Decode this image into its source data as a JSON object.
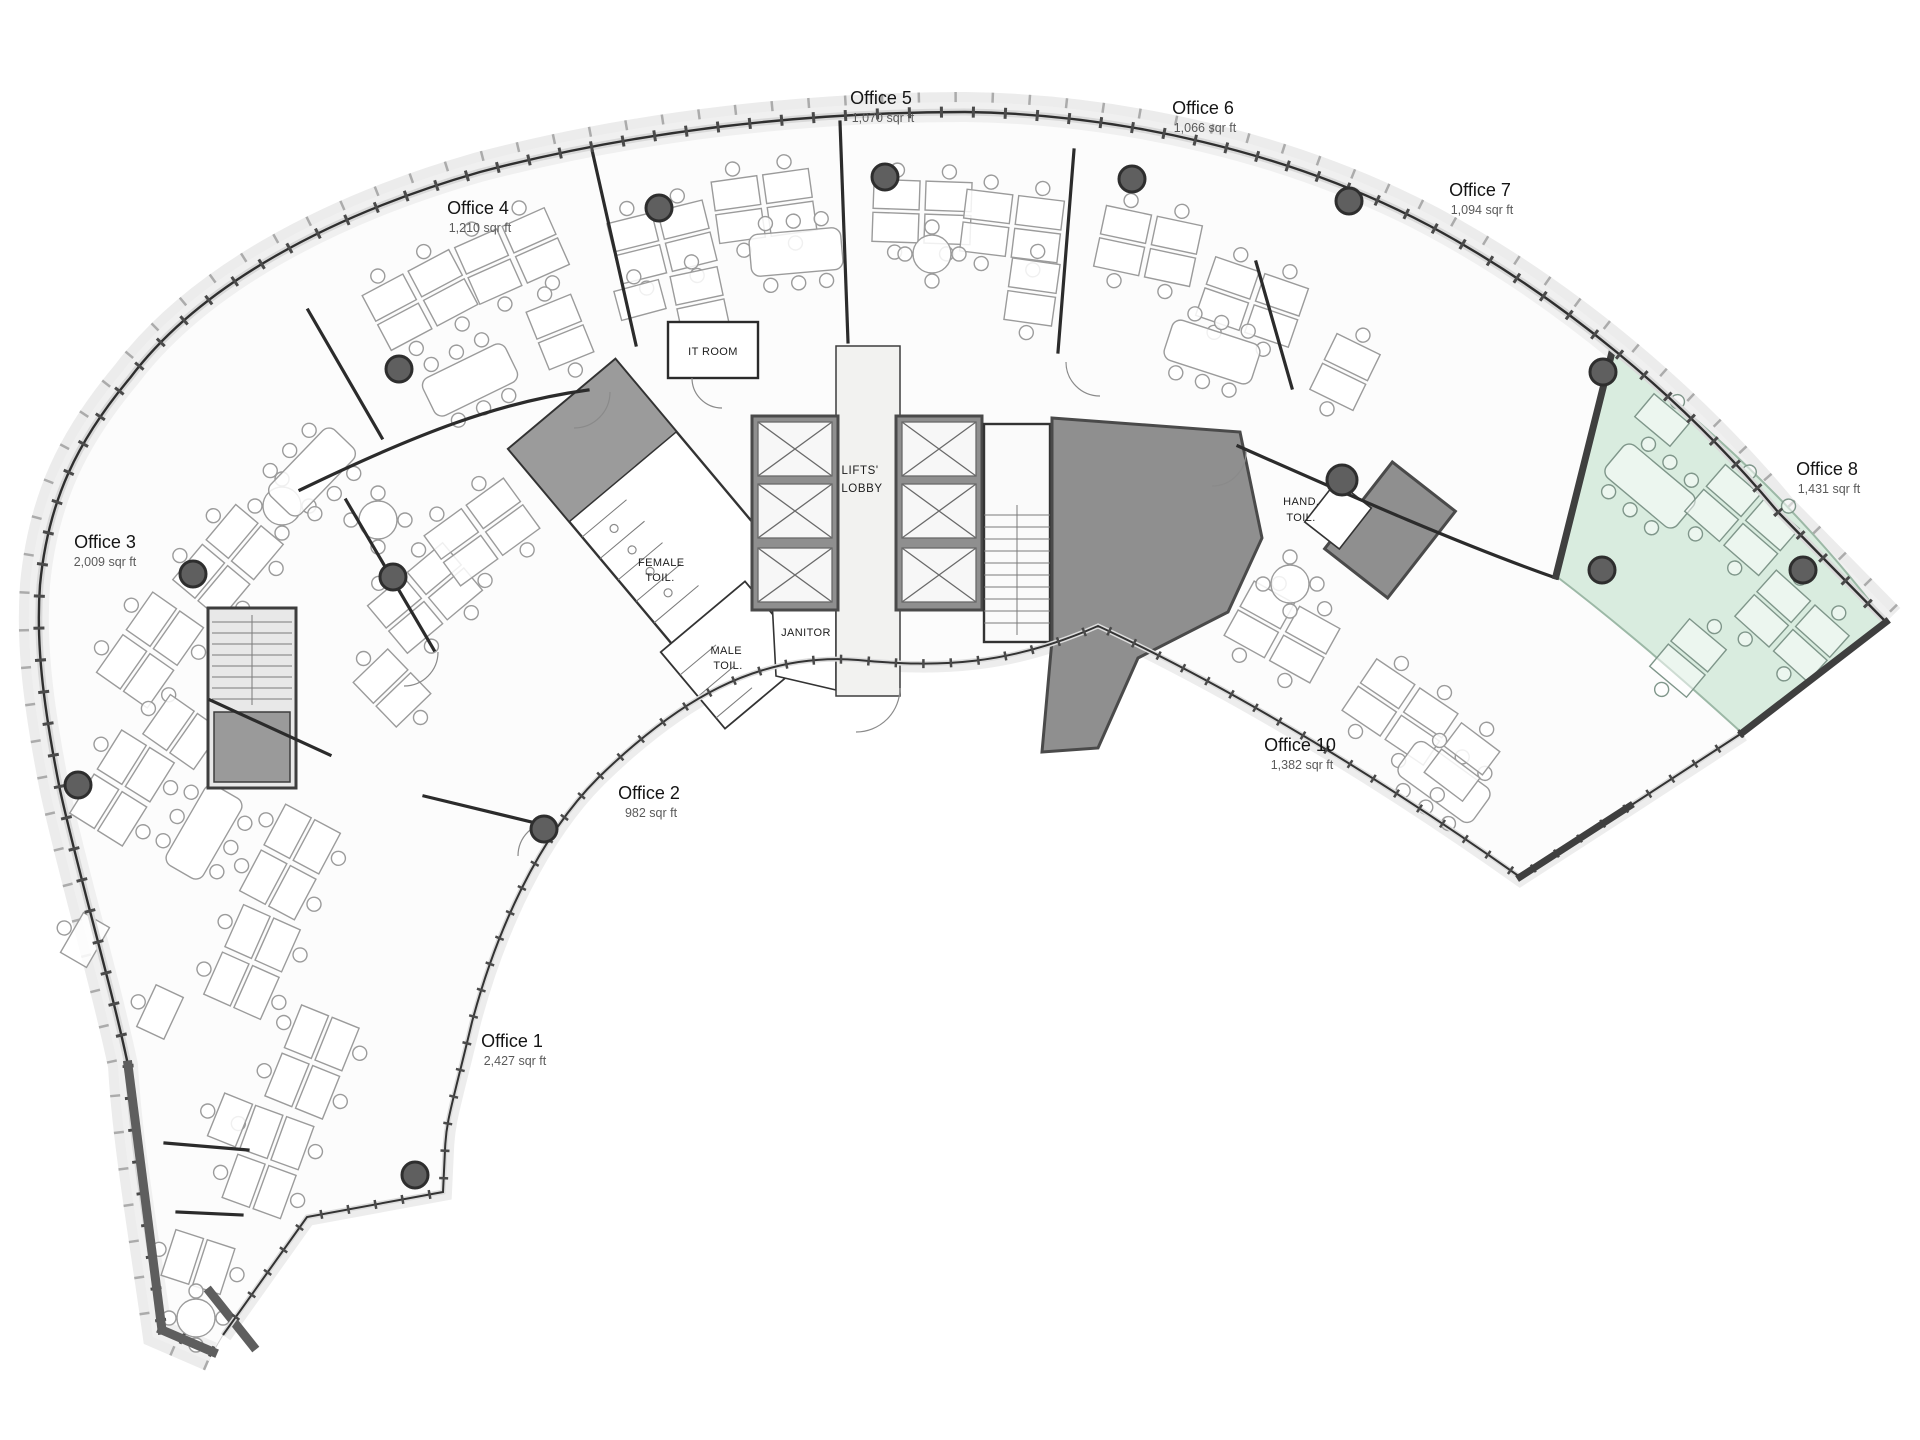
{
  "plan": {
    "kind": "office-floor-plan",
    "highlighted_office": "Office 8"
  },
  "colors": {
    "highlight": "#d9ecdf",
    "highlight_edge": "#9cb8a6",
    "column": "#5f5f5f",
    "core": "#8f8f8f"
  },
  "offices": [
    {
      "name": "Office 1",
      "area": "2,427 sqr ft"
    },
    {
      "name": "Office 2",
      "area": "982 sqr ft"
    },
    {
      "name": "Office 3",
      "area": "2,009 sqr ft"
    },
    {
      "name": "Office 4",
      "area": "1,210 sqr ft"
    },
    {
      "name": "Office 5",
      "area": "1,070 sqr ft"
    },
    {
      "name": "Office 6",
      "area": "1,066 sqr ft"
    },
    {
      "name": "Office 7",
      "area": "1,094 sqr ft"
    },
    {
      "name": "Office 8",
      "area": "1,431 sqr ft",
      "highlighted": true
    },
    {
      "name": "Office 10",
      "area": "1,382 sqr ft"
    }
  ],
  "core_rooms": {
    "lifts_lobby": {
      "line1": "LIFTS'",
      "line2": "LOBBY"
    },
    "it_room": {
      "line1": "IT ROOM"
    },
    "female_toilet": {
      "line1": "FEMALE",
      "line2": "TOIL."
    },
    "male_toilet": {
      "line1": "MALE",
      "line2": "TOIL."
    },
    "janitor": {
      "line1": "JANITOR"
    },
    "hand_toilet": {
      "line1": "HAND.",
      "line2": "TOIL."
    }
  }
}
